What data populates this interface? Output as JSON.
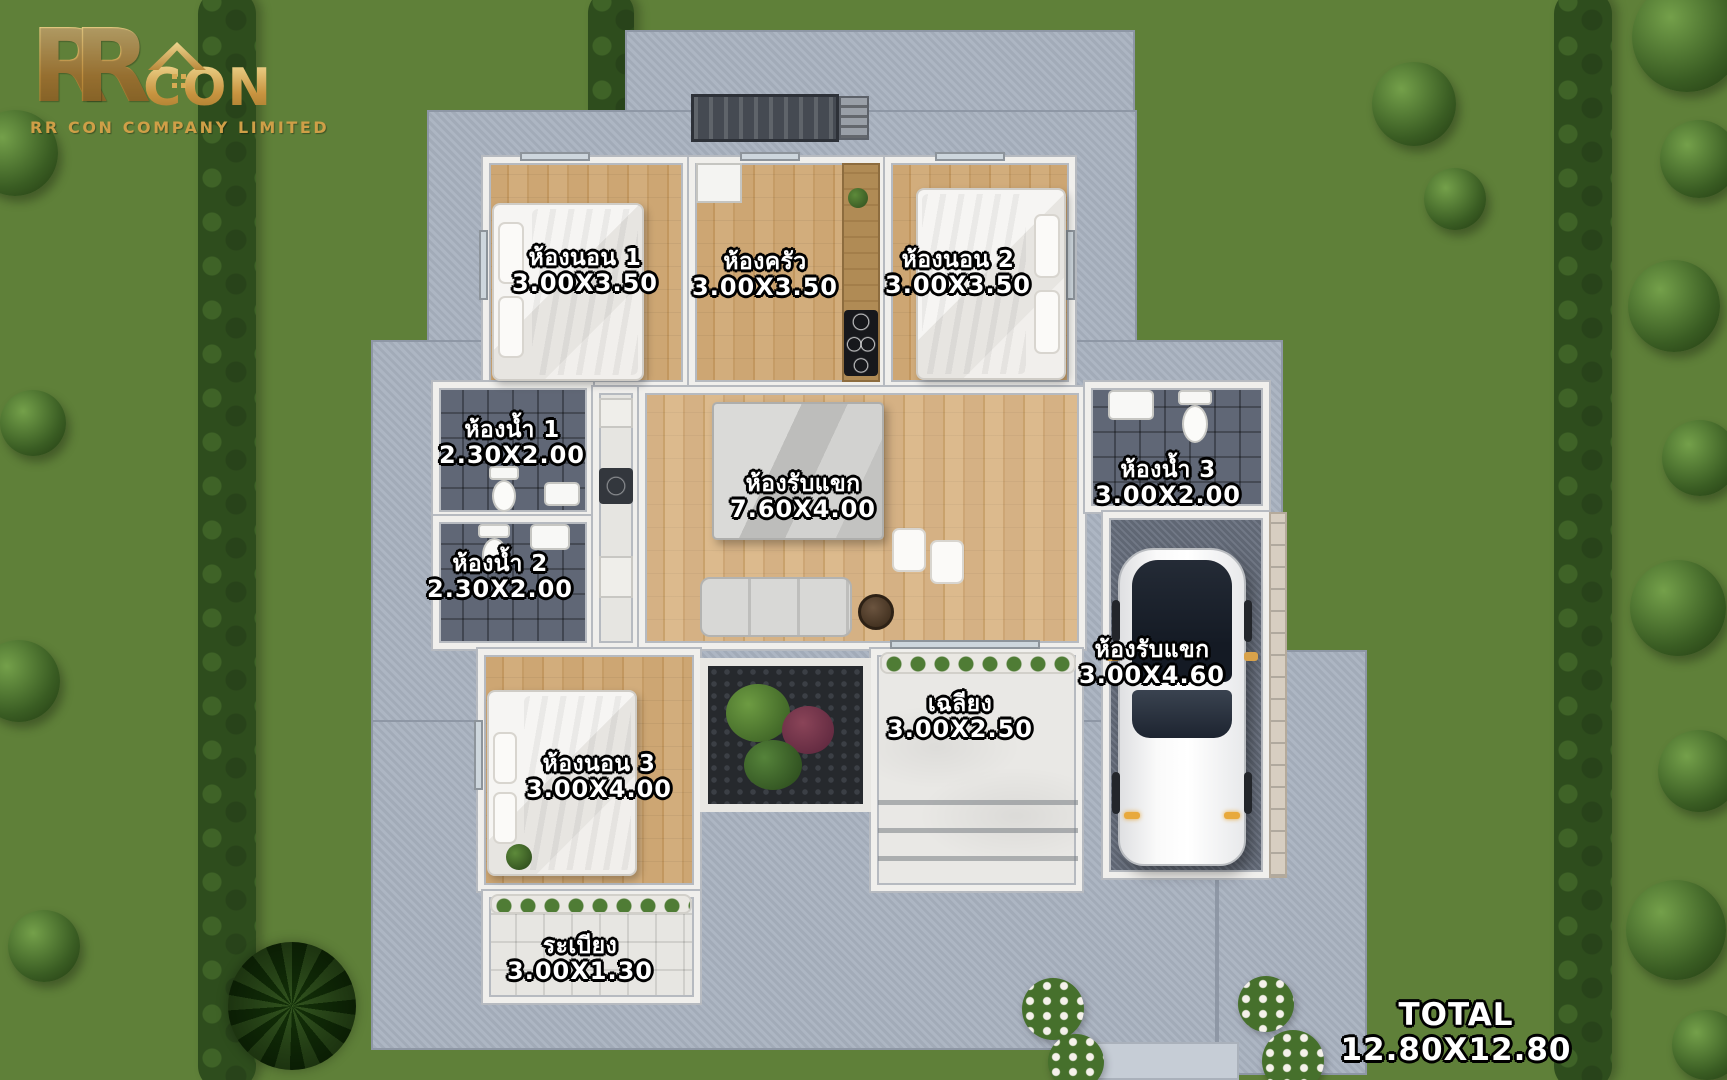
{
  "logo": {
    "letter1": "R",
    "letter2": "R",
    "suffix": "CON",
    "company": "RR CON COMPANY LIMITED"
  },
  "rooms": [
    {
      "id": "bedroom-1",
      "name": "ห้องนอน 1",
      "size": "3.00X3.50"
    },
    {
      "id": "kitchen",
      "name": "ห้องครัว",
      "size": "3.00X3.50"
    },
    {
      "id": "bedroom-2",
      "name": "ห้องนอน 2",
      "size": "3.00X3.50"
    },
    {
      "id": "bathroom-1",
      "name": "ห้องน้ำ 1",
      "size": "2.30X2.00"
    },
    {
      "id": "bathroom-2",
      "name": "ห้องน้ำ 2",
      "size": "2.30X2.00"
    },
    {
      "id": "living-room",
      "name": "ห้องรับแขก",
      "size": "7.60X4.00"
    },
    {
      "id": "bathroom-3",
      "name": "ห้องน้ำ 3",
      "size": "3.00X2.00"
    },
    {
      "id": "carport",
      "name": "ห้องรับแขก",
      "size": "3.00X4.60"
    },
    {
      "id": "bedroom-3",
      "name": "ห้องนอน 3",
      "size": "3.00X4.00"
    },
    {
      "id": "porch",
      "name": "เฉลียง",
      "size": "3.00X2.50"
    },
    {
      "id": "terrace",
      "name": "ระเบียง",
      "size": "3.00X1.30"
    }
  ],
  "total": {
    "label": "TOTAL",
    "size": "12.80X12.80"
  },
  "colors": {
    "logo_gold": "#d4a74f",
    "grass": "#5f8039",
    "hedge": "#2e4d1d",
    "concrete": "#a9b2c0",
    "wood_floor": "#c9a06e",
    "dark_tile": "#5a6170",
    "marble": "#e9e8e5",
    "label_text": "#ffffff",
    "label_outline": "#000000"
  }
}
